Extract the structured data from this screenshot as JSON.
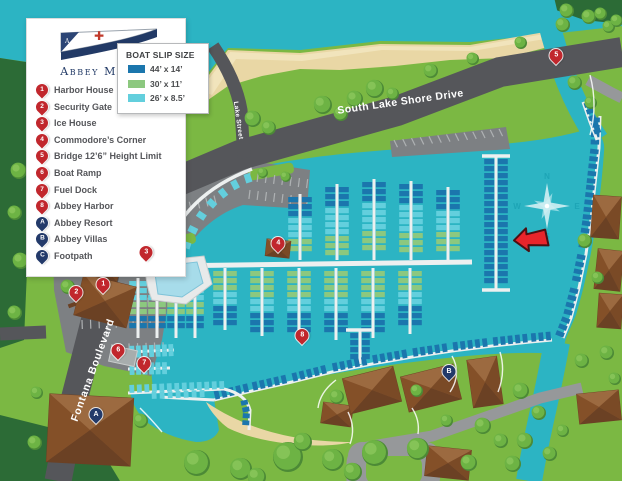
{
  "colors": {
    "water": "#2cb4c3",
    "grass": "#7bb843",
    "dark_green": "#2c6b36",
    "beach": "#e9d7a5",
    "beach_light": "#f2e6bf",
    "road_dark": "#55565a",
    "road_light": "#96989a",
    "parking": "#7d8083",
    "stripe": "#aeb1b3",
    "dock": "#edf0f0",
    "slip_44": "#1b76ad",
    "slip_30": "#8cc87f",
    "slip_26": "#63cfdd",
    "building": "#8a5a38",
    "building_dark": "#6b4124",
    "building_light": "#9c6a40",
    "pool": "#a7dcea",
    "pin_red": "#c1272d",
    "pin_navy": "#233a6a",
    "arrow_red": "#e8252b",
    "compass_light": "#cfeef3",
    "compass_letter": "#19a0b2",
    "tree_base": "#4c8a36",
    "tree_mid": "#6db344",
    "tree_hi": "#8ac65a"
  },
  "branding": {
    "name": "Abbey Marina"
  },
  "legend": {
    "items": [
      {
        "marker": "1",
        "label": "Harbor House"
      },
      {
        "marker": "2",
        "label": "Security Gate"
      },
      {
        "marker": "3",
        "label": "Ice House"
      },
      {
        "marker": "4",
        "label": "Commodore’s Corner"
      },
      {
        "marker": "5",
        "label": "Bridge 12’6” Height Limit"
      },
      {
        "marker": "6",
        "label": "Boat Ramp"
      },
      {
        "marker": "7",
        "label": "Fuel Dock"
      },
      {
        "marker": "8",
        "label": "Abbey Harbor"
      },
      {
        "marker": "A",
        "label": "Abbey Resort"
      },
      {
        "marker": "B",
        "label": "Abbey Villas"
      },
      {
        "marker": "C",
        "label": "Footpath"
      }
    ]
  },
  "slip_legend": {
    "title": "BOAT SLIP SIZE",
    "items": [
      {
        "label": "44’ x 14’",
        "color": "#1b76ad"
      },
      {
        "label": "30’ x 11’",
        "color": "#8cc87f"
      },
      {
        "label": "26’ x 8.5’",
        "color": "#63cfdd"
      }
    ]
  },
  "roads": {
    "main": "South Lake Shore Drive",
    "lake": "Lake Street",
    "fontana": "Fontana Boulevard"
  },
  "map_markers": [
    {
      "marker": "1",
      "x": 103,
      "y": 291
    },
    {
      "marker": "2",
      "x": 76,
      "y": 299
    },
    {
      "marker": "3",
      "x": 146,
      "y": 259
    },
    {
      "marker": "4",
      "x": 278,
      "y": 250
    },
    {
      "marker": "5",
      "x": 556,
      "y": 62
    },
    {
      "marker": "6",
      "x": 118,
      "y": 357
    },
    {
      "marker": "7",
      "x": 144,
      "y": 370
    },
    {
      "marker": "8",
      "x": 302,
      "y": 342
    },
    {
      "marker": "A",
      "x": 96,
      "y": 421
    },
    {
      "marker": "B",
      "x": 449,
      "y": 378
    }
  ],
  "compass": {
    "n": "N",
    "e": "E",
    "s": "S",
    "w": "W"
  }
}
